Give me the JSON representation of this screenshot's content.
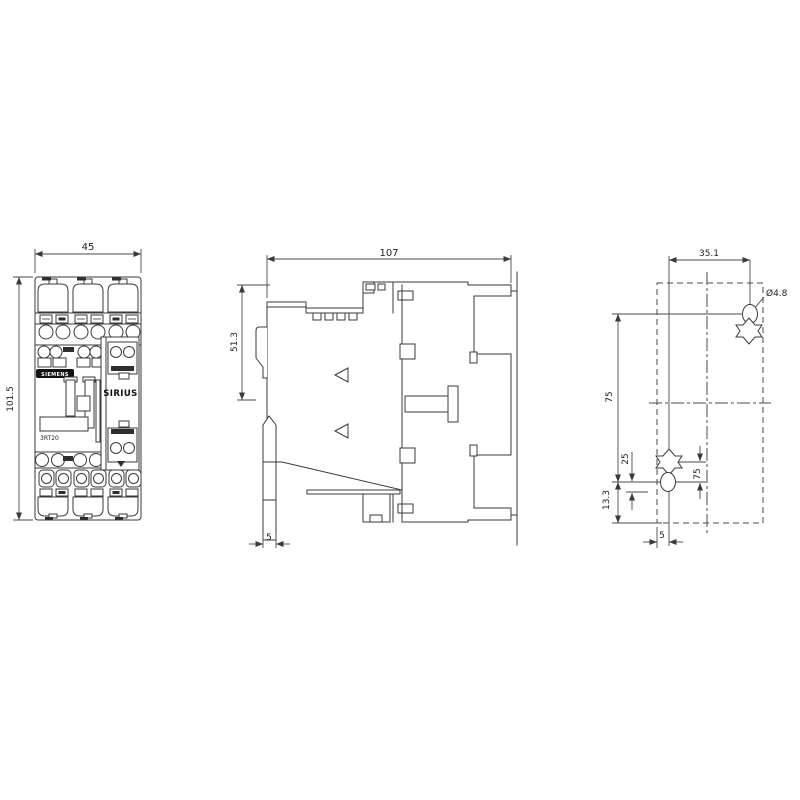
{
  "colors": {
    "line": "#3a3a3a",
    "text": "#1f1f1f",
    "brand_bg": "#111111",
    "brand_fg": "#ffffff"
  },
  "front": {
    "width_dim": "45",
    "height_dim": "101.5",
    "brand": "SIEMENS",
    "series": "SIRIUS",
    "model": "3RT20"
  },
  "side": {
    "width_dim": "107",
    "upper_height_dim": "51.3",
    "rail_clip_dim": "5"
  },
  "drilling": {
    "hole_spacing_h_dim": "35.1",
    "hole_diameter_dim": "Ø4.8",
    "hole_spacing_v_dim": "75",
    "slot_offset_small_dim": "25",
    "slot_offset_dim": "75",
    "bottom_offset_dim": "13.3",
    "edge_offset_dim": "5"
  }
}
